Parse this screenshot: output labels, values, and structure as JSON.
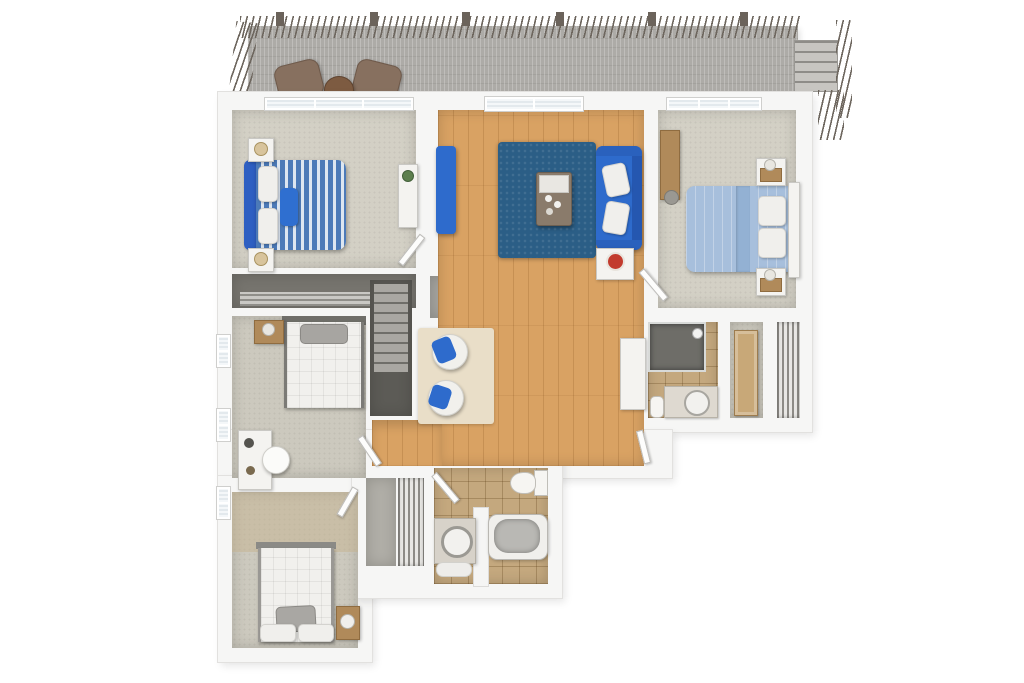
{
  "scene": {
    "kind": "3d-floor-plan-render",
    "view": "top-down dollhouse",
    "background_color": "#ffffff",
    "visible_text": "none"
  },
  "palette": {
    "wall": "#f6f6f5",
    "hardwood": "#d9a263",
    "carpet": "#d3d0c5",
    "bath_tile": "#c4a87e",
    "deck_boards": "#adaba7",
    "sofa_blue": "#2e6bcc",
    "rug_blue": "#2b5e86",
    "bed_stripe_blue": "#4c7ab8",
    "bed_light_blue": "#a7bfdc",
    "wood_furniture": "#b08a5a",
    "stairs_gray": "#a9a7a2",
    "decor_red": "#c23b2e"
  },
  "deck": {
    "name": "roof deck",
    "features": [
      "perimeter baluster railing (top and left)",
      "exterior stair run at right with railing"
    ],
    "furniture": [
      "brown lounge chair",
      "brown lounge chair",
      "round wood side table"
    ]
  },
  "rooms": [
    {
      "name": "bedroom-upper-left",
      "floor": "carpet",
      "furniture": [
        "double bed with blue/white striped duvet",
        "blue headboard",
        "blue accent pillow",
        "two white pillows",
        "two nightstands with lamps",
        "white dresser with plant",
        "triple window on top wall"
      ]
    },
    {
      "name": "living-room",
      "floor": "hardwood",
      "furniture": [
        "blue sofa with two white pillows",
        "narrow blue bench",
        "dark blue shag rug",
        "coffee table with white tray",
        "white side table with red decor object",
        "cream rug",
        "two round white chairs with blue throws",
        "tall white cabinet",
        "sliding glass door to deck"
      ]
    },
    {
      "name": "bedroom-upper-right",
      "floor": "carpet",
      "furniture": [
        "double bed with light blue duvet",
        "white headboard",
        "two white pillows",
        "two white/wood nightstands with lamps",
        "wood desk with chair",
        "triple window on top wall"
      ]
    },
    {
      "name": "bedroom-middle-left",
      "floor": "carpet",
      "furniture": [
        "white quilted bed",
        "gray pillow",
        "dark headboard strip",
        "wood nightstand with lamp",
        "white desk with round chair",
        "two windows on left wall"
      ]
    },
    {
      "name": "bedroom-bottom-left",
      "floor": "carpet",
      "furniture": [
        "white quilted bed",
        "gray accent pillow",
        "two white pillows",
        "wood nightstand with lamp",
        "window on left wall"
      ]
    },
    {
      "name": "bathroom-center",
      "floor": "tile",
      "fixtures": [
        "vanity with round sink",
        "toilet",
        "bathtub",
        "partition wall",
        "entry door"
      ]
    },
    {
      "name": "bathroom-right",
      "floor": "tile",
      "fixtures": [
        "walk-in shower",
        "vanity with round sink",
        "toilet"
      ]
    },
    {
      "name": "hallway",
      "floor": "hardwood"
    },
    {
      "name": "stairwell",
      "features": [
        "carpeted staircase going down",
        "gray landing"
      ]
    },
    {
      "name": "closet-upper-left",
      "type": "sliding-door closet"
    },
    {
      "name": "closet-bottom-center",
      "type": "louvered-door closet"
    },
    {
      "name": "closet-right",
      "type": "linen closet with paneled door + louvered closet"
    }
  ]
}
